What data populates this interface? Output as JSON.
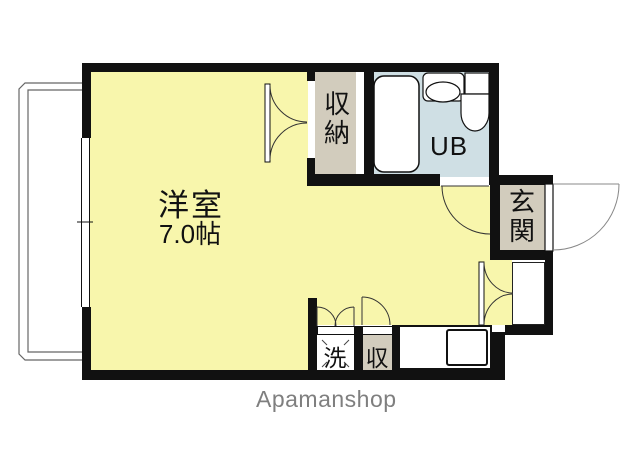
{
  "floorplan": {
    "watermark": "Apamanshop",
    "rooms": {
      "main": {
        "name": "洋室",
        "size": "7.0帖"
      },
      "closet": {
        "name": "収納",
        "chars": [
          "収",
          "納"
        ]
      },
      "bath": {
        "name": "UB"
      },
      "entrance": {
        "name": "玄関",
        "chars": [
          "玄",
          "関"
        ]
      },
      "laundry": {
        "name": "洗"
      },
      "storage": {
        "name": "収"
      }
    },
    "colors": {
      "room_fill": "#F8F6AC",
      "closet_fill": "#D2CCBD",
      "bath_fill": "#CFDFE4",
      "entrance_fill": "#D2CCBD",
      "wall": "#111111",
      "watermark_text": "#7F7F7F"
    }
  }
}
